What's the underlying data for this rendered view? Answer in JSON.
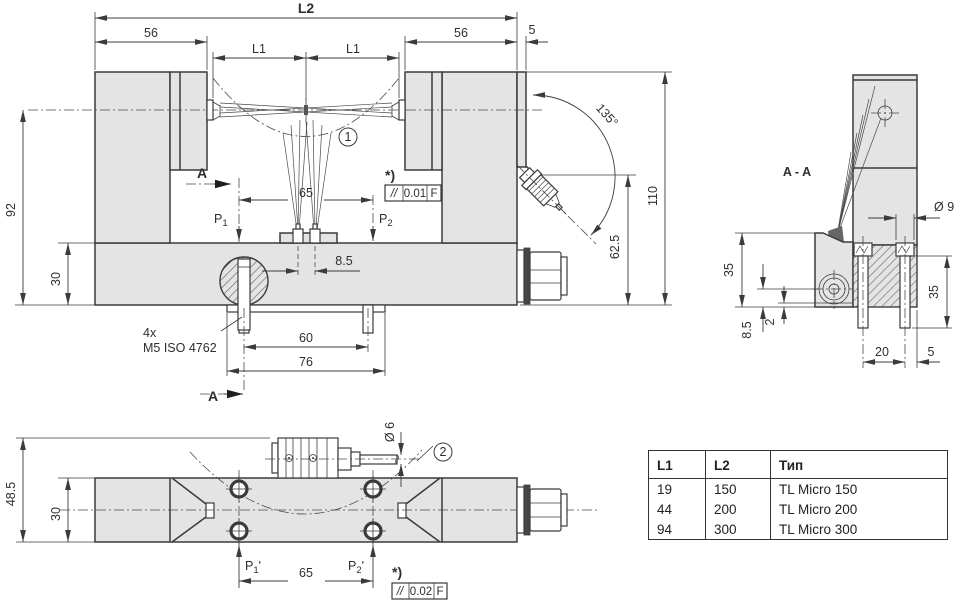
{
  "drawing_title": "TL Micro dimensional drawing",
  "colors": {
    "body_fill": "#e4e4e4",
    "line": "#3b3b3b"
  },
  "front": {
    "dims": {
      "l2": "L2",
      "s56l": "56",
      "s56r": "56",
      "s5": "5",
      "l1l": "L1",
      "l1r": "L1",
      "h110": "110",
      "h62": "62.5",
      "angle": "135°",
      "h92": "92",
      "h30": "30",
      "s65": "65",
      "s85": "8.5",
      "s60": "60",
      "s76": "76"
    },
    "labels": {
      "section_a": "A",
      "star": "*)",
      "callout1": "1",
      "screws_line1": "4x",
      "screws_line2": "M5 ISO 4762",
      "p_base": "P",
      "p1_sub": "1",
      "p2_sub": "2"
    },
    "fcf": {
      "sym": "//",
      "val": "0.01",
      "datum": "F"
    }
  },
  "section": {
    "title": "A - A",
    "dims": {
      "d9": "Ø 9",
      "l35": "35",
      "r35": "35",
      "b85": "8.5",
      "t2": "2",
      "b20": "20",
      "b5": "5"
    }
  },
  "bottom": {
    "dims": {
      "h485": "48.5",
      "h30": "30",
      "d6": "Ø 6",
      "s65": "65"
    },
    "labels": {
      "star": "*)",
      "callout2": "2",
      "p_base": "P",
      "p1_sub": "1",
      "p2_sub": "2",
      "prime": "'"
    },
    "fcf": {
      "sym": "//",
      "val": "0.02",
      "datum": "F"
    }
  },
  "table": {
    "headers": [
      "L1",
      "L2",
      "Тип"
    ],
    "rows": [
      [
        "19",
        "150",
        "TL Micro 150"
      ],
      [
        "44",
        "200",
        "TL Micro 200"
      ],
      [
        "94",
        "300",
        "TL Micro 300"
      ]
    ]
  }
}
